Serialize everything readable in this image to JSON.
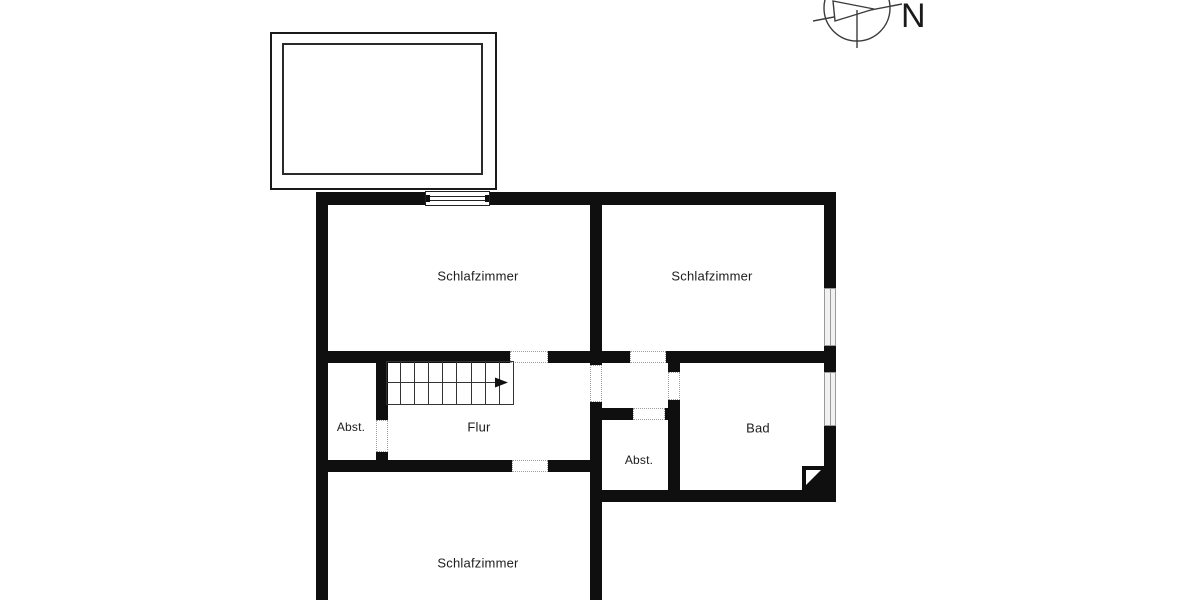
{
  "plan": {
    "type": "floor-plan",
    "rooms": [
      {
        "name": "schlafzimmer-nordwest",
        "label": "Schlafzimmer"
      },
      {
        "name": "schlafzimmer-nordost",
        "label": "Schlafzimmer"
      },
      {
        "name": "abstellraum-west",
        "label": "Abst."
      },
      {
        "name": "flur",
        "label": "Flur"
      },
      {
        "name": "abstellraum-mitte",
        "label": "Abst."
      },
      {
        "name": "bad",
        "label": "Bad"
      },
      {
        "name": "schlafzimmer-sued",
        "label": "Schlafzimmer"
      }
    ],
    "compass": {
      "label": "N"
    },
    "features": [
      "balcony",
      "staircase",
      "chimney",
      "windows",
      "doorways"
    ],
    "colors": {
      "wall": "#0f0f0f",
      "background": "#ffffff",
      "window_fill": "#f1f1f1",
      "window_stroke": "#9a9a9a",
      "doorway_dots": "#9e9e9e",
      "label_text": "#1c1c1c"
    }
  }
}
